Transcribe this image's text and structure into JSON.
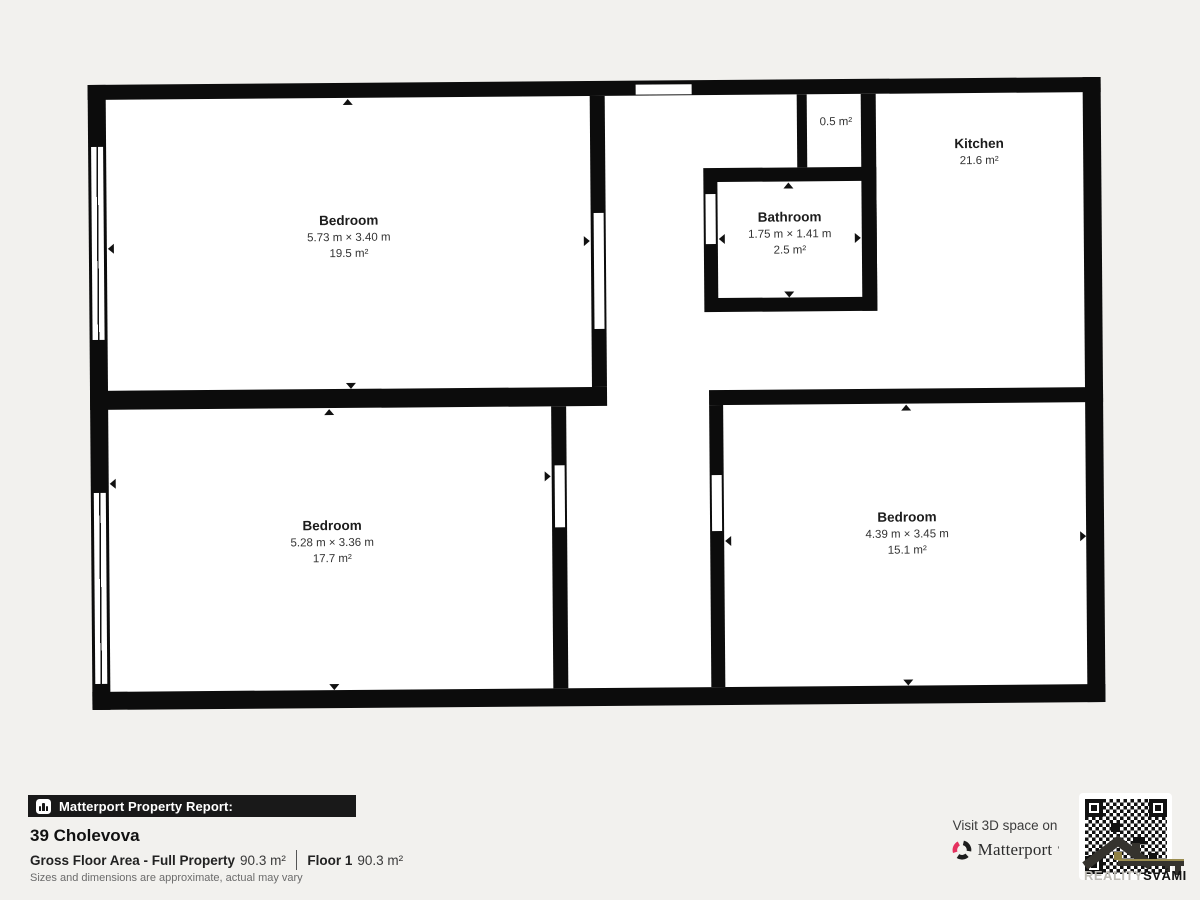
{
  "plan": {
    "rooms": [
      {
        "name": "Bedroom",
        "dimensions": "5.73 m × 3.40 m",
        "area": "19.5 m²"
      },
      {
        "name": "Bathroom",
        "dimensions": "1.75 m × 1.41 m",
        "area": "2.5 m²"
      },
      {
        "name": "Kitchen",
        "area": "21.6 m²"
      },
      {
        "area": "0.5 m²"
      },
      {
        "name": "Bedroom",
        "dimensions": "5.28 m × 3.36 m",
        "area": "17.7 m²"
      },
      {
        "name": "Bedroom",
        "dimensions": "4.39 m × 3.45 m",
        "area": "15.1 m²"
      }
    ]
  },
  "report": {
    "header": "Matterport Property Report:",
    "address": "39 Cholevova",
    "gross_label": "Gross Floor Area - Full Property",
    "gross_value": "90.3 m²",
    "floor_label": "Floor 1",
    "floor_value": "90.3 m²",
    "disclaimer": "Sizes and dimensions are approximate, actual may vary"
  },
  "promo": {
    "visit_text": "Visit 3D space on",
    "brand": "Matterport",
    "brand_mark": "’",
    "agency_light": "REALITY",
    "agency_bold": "SVÁMI"
  },
  "colors": {
    "background": "#f2f1ee",
    "wall": "#0c0c0c",
    "brand_pink": "#e5315e",
    "report_bar": "#191919"
  }
}
